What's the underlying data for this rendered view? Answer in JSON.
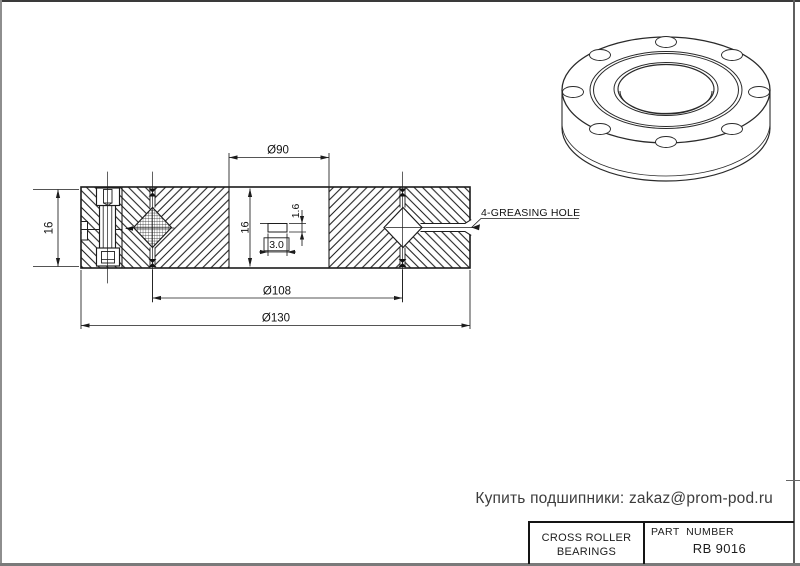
{
  "colors": {
    "line": "#1c1c1c",
    "frame": "#6f6f6f",
    "background": "#ffffff"
  },
  "contact_line": "Купить подшипники: zakaz@prom-pod.ru",
  "title_block": {
    "product_line1": "CROSS ROLLER",
    "product_line2": "BEARINGS",
    "part_number_label": "PART  NUMBER",
    "part_number": "RB 9016"
  },
  "drawing": {
    "dim_bore_diameter": "Ø90",
    "dim_pitch_diameter": "Ø108",
    "dim_outer_diameter": "Ø130",
    "dim_section_height": "16",
    "dim_bore_height": "16",
    "dim_groove_height": "1.6",
    "dim_groove_width": "3.0",
    "greasing_hole_label": "4-GREASING HOLE"
  }
}
